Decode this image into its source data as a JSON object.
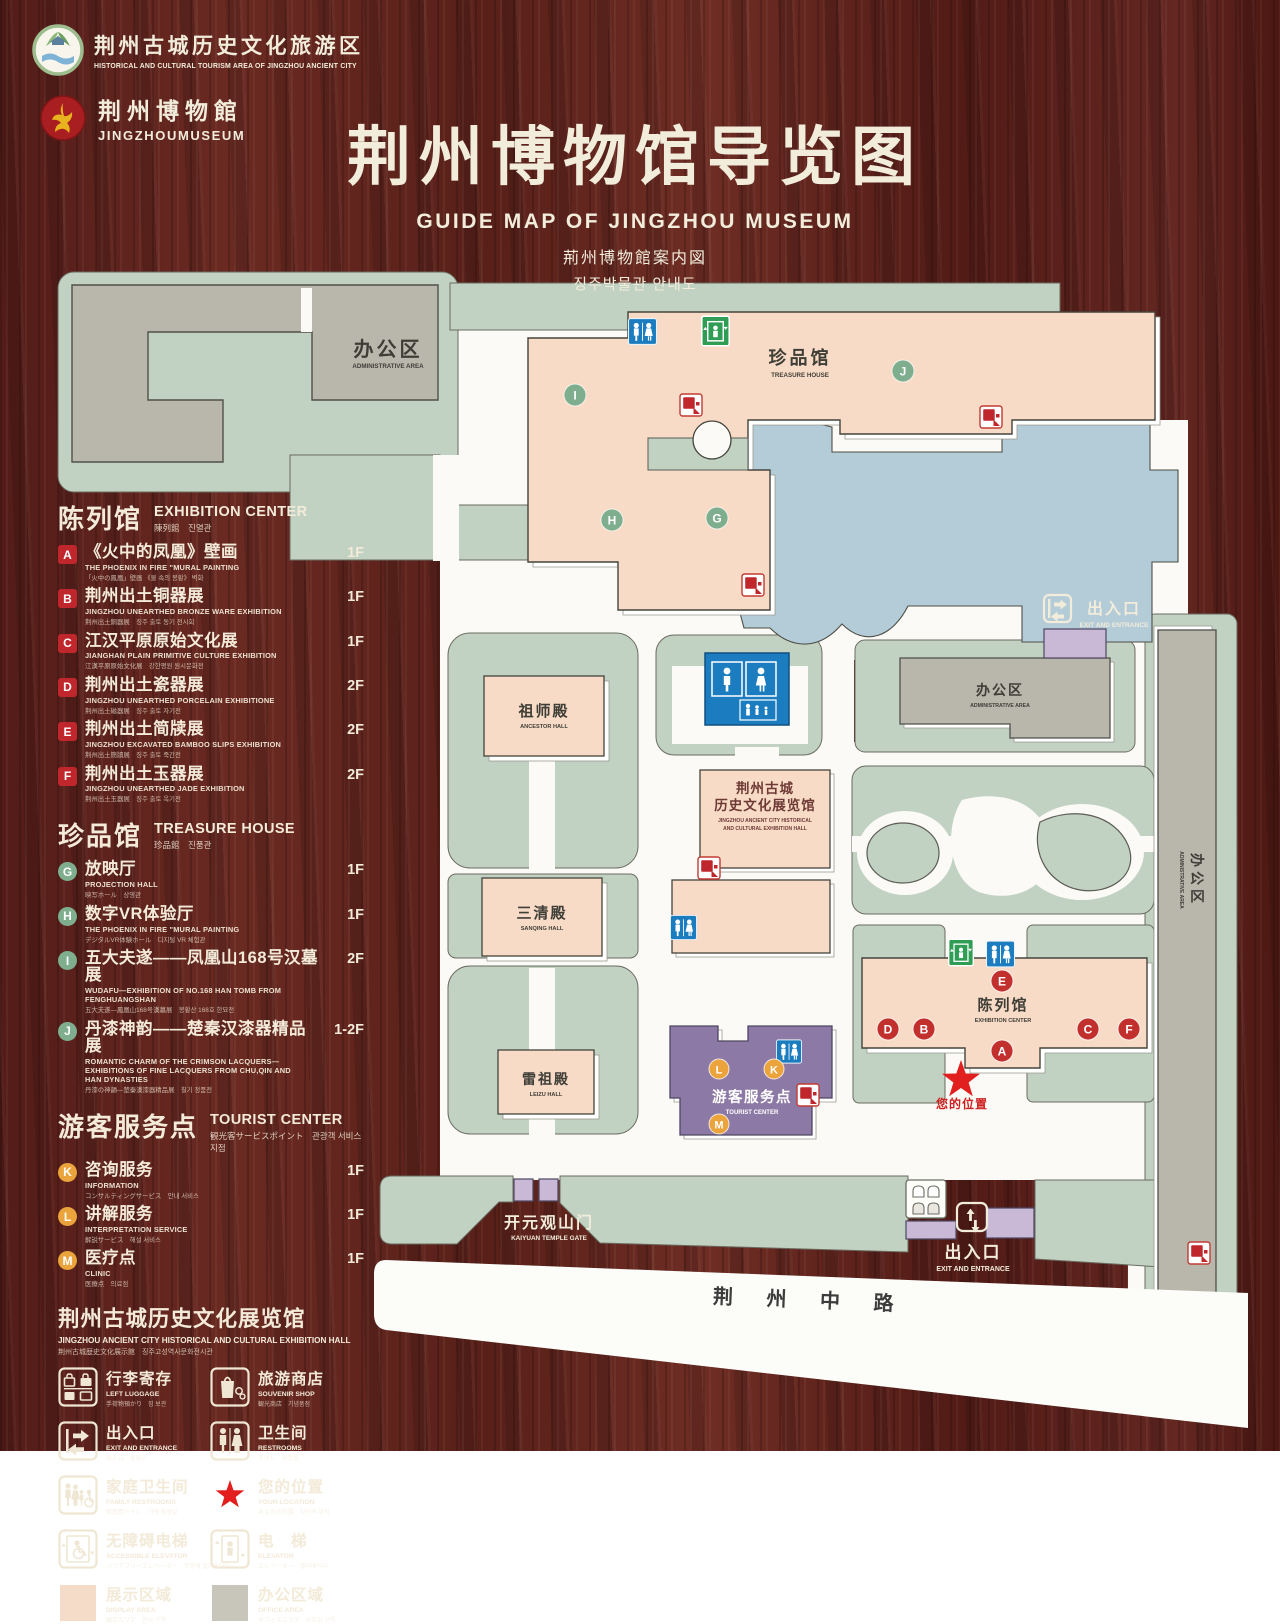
{
  "header": {
    "logo1": {
      "zh": "荆州古城历史文化旅游区",
      "en": "HISTORICAL AND CULTURAL TOURISM AREA OF JINGZHOU ANCIENT CITY"
    },
    "logo2": {
      "zh": "荆州博物館",
      "en": "JINGZHOUMUSEUM"
    },
    "title": "荆州博物馆导览图",
    "subtitle_en": "GUIDE MAP OF JINGZHOU MUSEUM",
    "subtitle_jp": "荊州博物館案内図",
    "subtitle_kr": "징주박물관 안내도"
  },
  "legend": {
    "sections": [
      {
        "title_zh": "陈列馆",
        "title_en": "EXHIBITION CENTER",
        "title_sub": "陳列館　진열관",
        "items": [
          {
            "letter": "A",
            "zh": "《火中的凤凰》壁画",
            "en": "THE PHOENIX IN FIRE \"MURAL PAINTING",
            "sub": "「火中の鳳凰」壁画 《불 속의 봉황》 벽화",
            "floor": "1F"
          },
          {
            "letter": "B",
            "zh": "荆州出土铜器展",
            "en": "JINGZHOU UNEARTHED BRONZE WARE EXHIBITION",
            "sub": "荆州出土銅器展　징주 출토 동기 전시회",
            "floor": "1F"
          },
          {
            "letter": "C",
            "zh": "江汉平原原始文化展",
            "en": "JIANGHAN PLAIN PRIMITIVE CULTURE EXHIBITION",
            "sub": "江漢平原原始文化展　강한평원 원시문화전",
            "floor": "1F"
          },
          {
            "letter": "D",
            "zh": "荆州出土瓷器展",
            "en": "JINGZHOU UNEARTHED PORCELAIN EXHIBITIONE",
            "sub": "荆州出土磁器展　징주 출토 자기전",
            "floor": "2F"
          },
          {
            "letter": "E",
            "zh": "荆州出土简牍展",
            "en": "JINGZHOU EXCAVATED BAMBOO SLIPS EXHIBITION",
            "sub": "荆州出土簡牘展　징주 출토 죽간전",
            "floor": "2F"
          },
          {
            "letter": "F",
            "zh": "荆州出土玉器展",
            "en": "JINGZHOU UNEARTHED JADE EXHIBITION",
            "sub": "荆州出土玉器展　징주 출토 옥기전",
            "floor": "2F"
          }
        ]
      },
      {
        "title_zh": "珍品馆",
        "title_en": "TREASURE HOUSE",
        "title_sub": "珍品館　진품관",
        "items": [
          {
            "letter": "G",
            "zh": "放映厅",
            "en": "PROJECTION HALL",
            "sub": "映写ホール　상영관",
            "floor": "1F"
          },
          {
            "letter": "H",
            "zh": "数字VR体验厅",
            "en": "THE PHOENIX IN FIRE \"MURAL PAINTING",
            "sub": "デジタルVR体験ホール　디지털 VR 체험관",
            "floor": "1F"
          },
          {
            "letter": "I",
            "zh": "五大夫遂——凤凰山168号汉墓展",
            "en": "WUDAFU—EXHIBITION OF NO.168 HAN TOMB FROM FENGHUANGSHAN",
            "sub": "五大夫遂—鳳凰山168号漢墓展　봉황산 168호 한묘전",
            "floor": "2F"
          },
          {
            "letter": "J",
            "zh": "丹漆神韵——楚秦汉漆器精品展",
            "en": "ROMANTIC CHARM OF THE CRIMSON LACQUERS— EXHIBITIONS OF FINE LACQUERS FROM CHU,QIN AND HAN DYNASTIES",
            "sub": "丹漆の神韻—楚秦漢漆器精品展　칠기 정품전",
            "floor": "1-2F"
          }
        ]
      },
      {
        "title_zh": "游客服务点",
        "title_en": "TOURIST CENTER",
        "title_sub": "観光客サービスポイント　관광객 서비스 지점",
        "items": [
          {
            "letter": "K",
            "zh": "咨询服务",
            "en": "INFORMATION",
            "sub": "コンサルティングサービス　안내 서비스",
            "floor": "1F"
          },
          {
            "letter": "L",
            "zh": "讲解服务",
            "en": "INTERPRETATION SERVICE",
            "sub": "解説サービス　해설 서비스",
            "floor": "1F"
          },
          {
            "letter": "M",
            "zh": "医疗点",
            "en": "CLINIC",
            "sub": "医療点　의료점",
            "floor": "1F"
          }
        ]
      }
    ],
    "hall": {
      "zh": "荆州古城历史文化展览馆",
      "en": "JINGZHOU ANCIENT CITY HISTORICAL AND CULTURAL EXHIBITION HALL",
      "sub": "荆州古城歴史文化展示館　징주고성역사문화전시관"
    },
    "icons": [
      {
        "id": "left-luggage",
        "zh": "行李寄存",
        "en": "LEFT LUGGAGE",
        "sub": "手荷物預かり　짐 보관"
      },
      {
        "id": "souvenir-shop",
        "zh": "旅游商店",
        "en": "SOUVENIR SHOP",
        "sub": "観光商店　기념품점"
      },
      {
        "id": "exit-entrance",
        "zh": "出入口",
        "en": "EXIT AND ENTRANCE",
        "sub": "出入口　출입구"
      },
      {
        "id": "restrooms",
        "zh": "卫生间",
        "en": "RESTROOMS",
        "sub": "トイレ　화장실"
      },
      {
        "id": "family-restrooms",
        "zh": "家庭卫生间",
        "en": "FAMILY RESTROOMS",
        "sub": "家庭用トイレ　가족 화장실"
      },
      {
        "id": "your-location",
        "zh": "您的位置",
        "en": "YOUR LOCATION",
        "sub": "あなたの位置　당신의 위치"
      },
      {
        "id": "accessible-elevator",
        "zh": "无障碍电梯",
        "en": "ACCESSIBLE ELEVATOR",
        "sub": "バリアフリーエレベーター　무장애 엘리베이터"
      },
      {
        "id": "elevator",
        "zh": "电　梯",
        "en": "ELEVATOR",
        "sub": "エレベーター　엘리베이터"
      },
      {
        "id": "display-area",
        "zh": "展示区域",
        "en": "DISPLAY AREA",
        "sub": "展示エリア　전시 구역"
      },
      {
        "id": "office-area",
        "zh": "办公区域",
        "en": "OFFICE AREA",
        "sub": "オフィスエリア　사무실 구역"
      }
    ]
  },
  "map": {
    "labels": {
      "admin_tl_zh": "办公区",
      "admin_tl_en": "ADMINISTRATIVE AREA",
      "treasure_zh": "珍品馆",
      "treasure_en": "TREASURE HOUSE",
      "ancestor_zh": "祖师殿",
      "ancestor_en": "ANCESTOR HALL",
      "sanqing_zh": "三清殿",
      "sanqing_en": "SANQING HALL",
      "leizu_zh": "雷祖殿",
      "leizu_en": "LEIZU HALL",
      "hall_zh1": "荆州古城",
      "hall_zh2": "历史文化展览馆",
      "hall_en1": "JINGZHOU ANCIENT CITY HISTORICAL",
      "hall_en2": "AND CULTURAL EXHIBITION HALL",
      "admin_mid_zh": "办公区",
      "admin_mid_en": "ADMINISTRATIVE AREA",
      "admin_right_zh": "办公区",
      "admin_right_en": "ADMINISTRATIVE AREA",
      "exhibition_zh": "陈列馆",
      "exhibition_en": "EXHIBITION CENTER",
      "tourist_zh": "游客服务点",
      "tourist_en": "TOURIST CENTER",
      "exit_top_zh": "出入口",
      "exit_top_en": "EXIT AND ENTRANCE",
      "exit_bottom_zh": "出入口",
      "exit_bottom_en": "EXIT AND ENTRANCE",
      "gate_zh": "开元观山门",
      "gate_en": "KAIYUAN TEMPLE GATE",
      "location_zh": "您的位置",
      "road": "荆 州 中 路"
    },
    "markers": {
      "A": "A",
      "B": "B",
      "C": "C",
      "D": "D",
      "E": "E",
      "F": "F",
      "G": "G",
      "H": "H",
      "I": "I",
      "J": "J",
      "K": "K",
      "L": "L",
      "M": "M"
    }
  },
  "colors": {
    "accent_red": "#c0272d",
    "sage_green": "#c1d2c3",
    "display_pink": "#f8dbc6",
    "pond_blue": "#b4cbd8",
    "tourist_purple": "#8d79a5",
    "gate_lavender": "#c9b9d6",
    "office_gray": "#b9b6ac",
    "restroom_blue": "#1b7dc0",
    "elevator_green": "#2f9e54",
    "marker_green": "#7fae8e",
    "marker_orange": "#eba33c",
    "cream_text": "#f2ecda"
  }
}
